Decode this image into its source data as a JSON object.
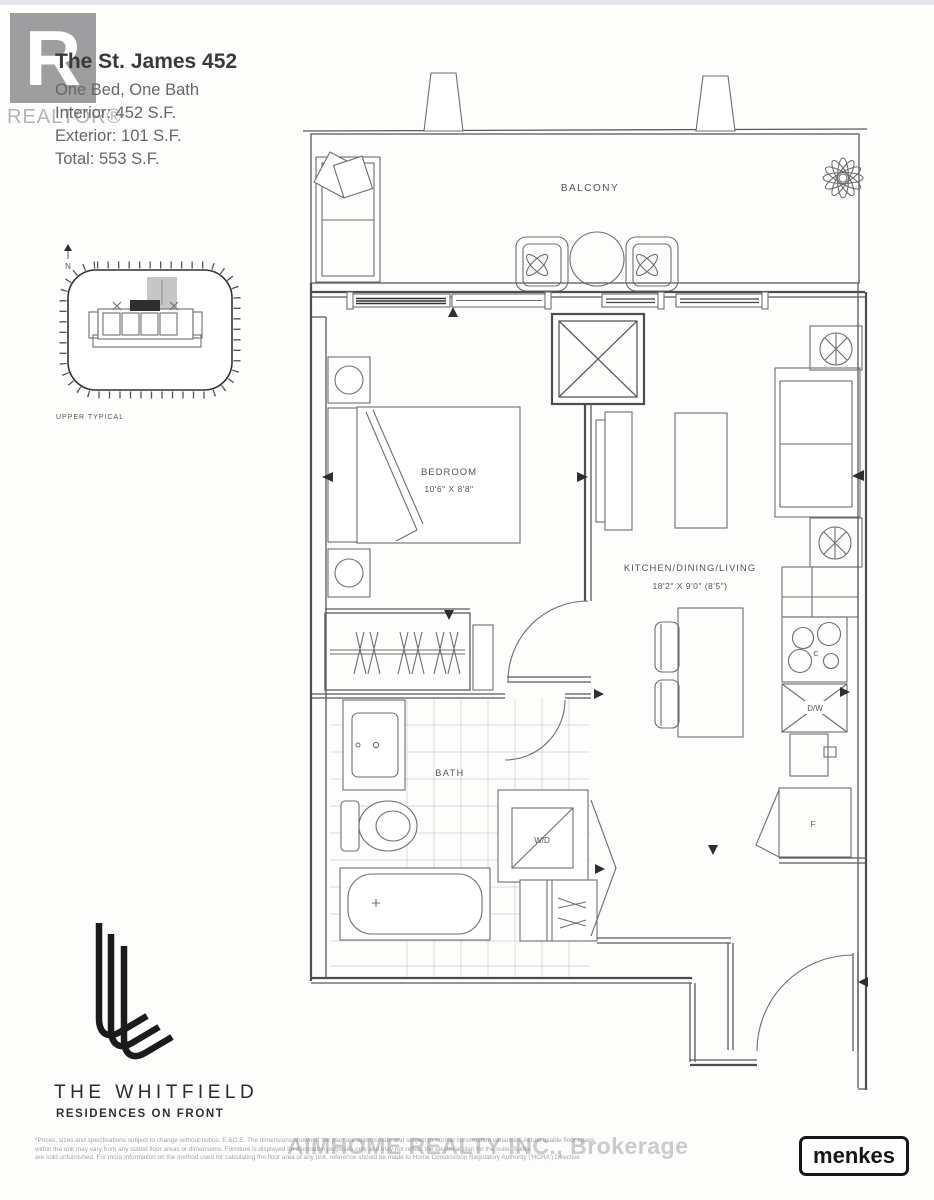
{
  "watermarks": {
    "realtor_letter": "R",
    "realtor_label": "REALTOR®",
    "brokerage_label": "AIMHOME REALTY INC., Brokerage"
  },
  "title_block": {
    "unit_name": "The St. James 452",
    "layout": "One Bed, One Bath",
    "interior": "Interior: 452 S.F.",
    "exterior": "Exterior: 101 S.F.",
    "total": "Total: 553 S.F."
  },
  "key_plan": {
    "north_label": "N",
    "caption": "UPPER TYPICAL"
  },
  "floor_plan": {
    "balcony": "BALCONY",
    "bedroom": "BEDROOM",
    "bedroom_dims": "10'6\" X 8'8\"",
    "kitchen": "KITCHEN/DINING/LIVING",
    "kitchen_dims": "18'2\" X 9'0\" (8'5\")",
    "bath": "BATH",
    "washer_dryer": "W/D",
    "dishwasher": "D/W",
    "cooktop": "C",
    "fridge": "F"
  },
  "branding": {
    "building_name": "THE WHITFIELD",
    "tagline": "RESIDENCES ON FRONT",
    "developer": "menkes"
  },
  "disclaimer": {
    "line1": "*Prices, sizes and specifications subject to change without notice. E.&O.E. The dimensions shown of the plan are approximate and subject to normal construction variances. Actual usable floor space",
    "line2": "within the unit may vary from any stated floor areas or dimensions. Furniture is displayed for illustration purposes only and may not reflect the electrical plan for the suite. Suites",
    "line3": "are sold unfurnished. For more information on the method used for calculating the floor area of any unit, reference should be made to Home Construction Regulatory Authority ('HCRA') Directive"
  },
  "colors": {
    "wall": "#4e4e4e",
    "furniture": "#6e6e6e",
    "watermark_gray": "#96969a"
  }
}
